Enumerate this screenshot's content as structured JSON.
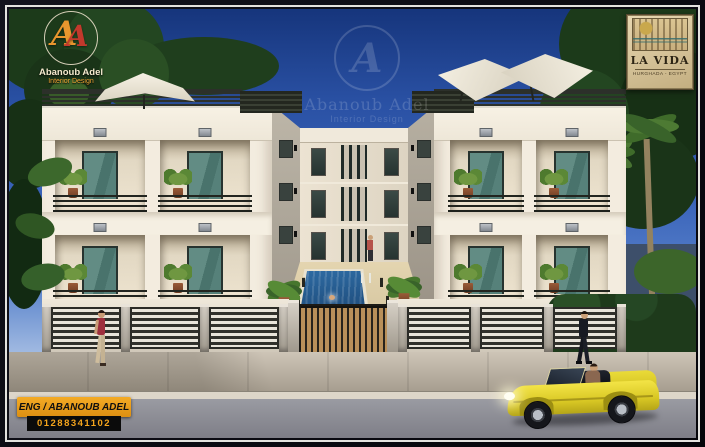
{
  "designer_logo": {
    "monogram": "A",
    "name": "Abanoub Adel",
    "tagline": "Interior Design",
    "orange": "#e8962e",
    "red": "#c2392c"
  },
  "watermark": {
    "monogram": "A",
    "name": "Abanoub Adel",
    "tagline": "Interior Design"
  },
  "project_badge": {
    "name": "LA VIDA",
    "location": "HURGHADA - EGYPT"
  },
  "contact_badge": {
    "engineer": "ENG / ABANOUB ADEL",
    "phone": "01288341102"
  },
  "palette": {
    "sky": "#2c55a8",
    "facade": "#f3ecdf",
    "balcony_glass": "#4a746d",
    "pool_water": "#1f4f80",
    "car_yellow": "#e6d431",
    "badge_orange": "#ee9d1e",
    "gate_wood": "#b9905a"
  }
}
